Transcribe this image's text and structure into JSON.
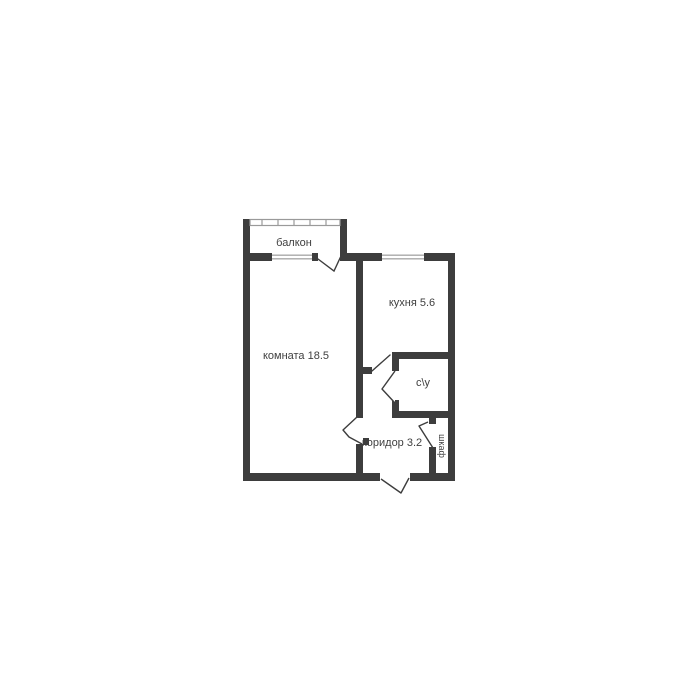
{
  "page": {
    "background_color": "#ffffff",
    "content": "apartment-floor-plan"
  },
  "floorplan": {
    "wall_color": "#3d3d3d",
    "label_color": "#3f3f3f",
    "window_line_color": "#a8a8a8",
    "rooms": [
      {
        "name": "balcony",
        "label": "балкон"
      },
      {
        "name": "living-room",
        "label": "комната 18.5",
        "area_m2": 18.5
      },
      {
        "name": "kitchen",
        "label": "кухня 5.6",
        "area_m2": 5.6
      },
      {
        "name": "bathroom",
        "label": "с\\у"
      },
      {
        "name": "corridor",
        "label": "коридор 3.2",
        "area_m2": 3.2
      },
      {
        "name": "closet",
        "label": "шкаф"
      }
    ]
  }
}
